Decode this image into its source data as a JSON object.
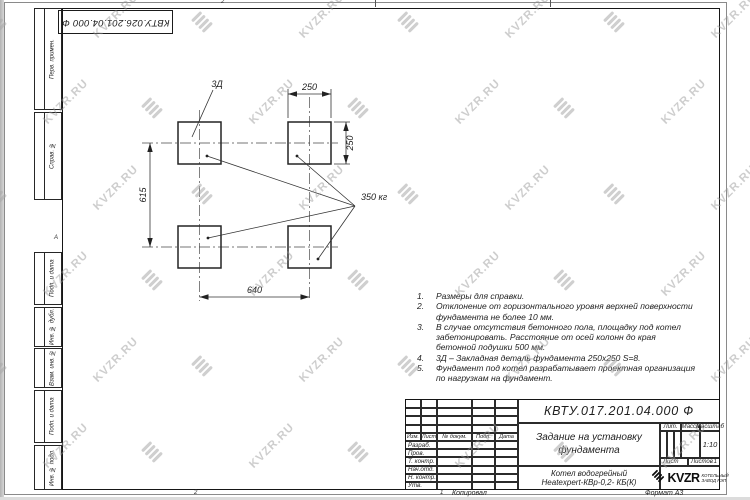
{
  "watermark": {
    "text": "KVZR.RU"
  },
  "stamp_top": {
    "designation": "КВТУ.026.201.04.000 Ф"
  },
  "margin": {
    "cells": [
      "Перв. примен.",
      "Справ. №",
      "Подп. и дата",
      "Инв. № дубл.",
      "Взам. инв. №",
      "Подп. и дата",
      "Инв. № подл."
    ]
  },
  "zones": {
    "top": "2",
    "left": "А",
    "bottom_a": "2",
    "bottom_b": "1"
  },
  "drawing": {
    "detail_label": "3Д",
    "load_label": "350 кг",
    "dim_width": "250",
    "dim_height": "250",
    "dim_span_x": "640",
    "dim_span_y": "615"
  },
  "notes": [
    "Размеры для справки.",
    "Отклонение от горизонтального уровня верхней поверхности фундамента не более 10 мм.",
    "В случае отсутствия бетонного пола, площадку под котел забетонировать. Расстояние от осей колонн до края бетонной подушки 500 мм.",
    "3Д – Закладная деталь фундамента 250х250 S=8.",
    "Фундамент под котел разрабатывает проектная организация по нагрузкам на фундамент."
  ],
  "title_block": {
    "designation": "КВТУ.017.201.04.000 Ф",
    "doc_title": "Задание на установку фундамента",
    "product": "Котел водогрейный",
    "product2": "Heatexpert-КВр-0,2- КБ(К)",
    "header_cols": [
      "Изм.",
      "Лист",
      "№ докум.",
      "Подп.",
      "Дата"
    ],
    "sign_rows": [
      "Разраб.",
      "Пров.",
      "Т. контр.",
      "Нач.отд.",
      "Н. контр.",
      "Утв."
    ],
    "lit_label": "Лит.",
    "mass_label": "Масса",
    "scale_label": "Масштаб",
    "scale_value": "1:10",
    "sheet_label": "Лист",
    "sheets_label": "Листов",
    "sheets_value": "1",
    "logo_text": "KVZR",
    "logo_sub1": "КОТЕЛЬНЫЙ",
    "logo_sub2": "ЗАВОД РЭП",
    "footer_copy": "Копировал",
    "footer_format": "Формат А3"
  }
}
